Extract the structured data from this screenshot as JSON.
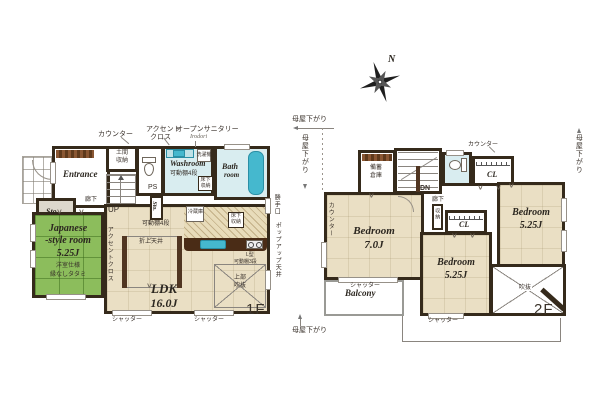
{
  "colors": {
    "wall": "#352a1b",
    "tatami": "#8cbd5c",
    "floor_beige": "#eadfc4",
    "wet_cyan": "#d9edf0",
    "fixture_cyan": "#45b8ce",
    "counter_brown": "#4a2c16"
  },
  "glyphs": {
    "door_v": "∨"
  },
  "f1": {
    "floor_label": "1F",
    "shutter": "シャッター",
    "notes": {
      "counter": "カウンター",
      "accent1": "アクセント",
      "accent2": "クロス",
      "open_sanitary": "オープンサニタリー",
      "irodori": "Irodori",
      "backdoor": "勝手口",
      "popup_ceiling": "ポップアップ天井"
    },
    "entrance": {
      "name": "Entrance",
      "doma1": "土間",
      "doma2": "収納",
      "ps": "PS",
      "up": "UP",
      "hall": "廊下",
      "sto": "Sto.",
      "sto_mid": "Sto."
    },
    "washroom": {
      "name": "Washroom",
      "shelf": "可動棚4段",
      "washer": "洗濯機",
      "uf1": "床下",
      "uf2": "収納"
    },
    "bath": {
      "name1": "Bath",
      "name2": "room"
    },
    "japanese": {
      "name1": "Japanese",
      "name2": "-style room",
      "area": "5.25J",
      "spec1": "洋室仕様",
      "spec2": "縁なしタタミ"
    },
    "ldk": {
      "name": "LDK",
      "area": "16.0J",
      "accent_wall": "アクセントクロス",
      "shelf": "可動棚4段",
      "oriage": "折上天井",
      "fridge": "冷蔵庫",
      "uf1": "床下",
      "uf2": "収納",
      "lshelf1": "L型",
      "lshelf2": "可動棚3段",
      "void1": "上部",
      "void2": "吹抜"
    }
  },
  "f2": {
    "floor_label": "2F",
    "compass_n": "N",
    "moya": "母屋下がり",
    "shutter": "シャッター",
    "notes": {
      "counter": "カウンター",
      "dn": "DN",
      "hall": "廊下",
      "cl": "CL",
      "storage": "収納",
      "stock1": "備蓄",
      "stock2": "倉庫",
      "counter_v": "カウンター"
    },
    "bed7": {
      "name": "Bedroom",
      "area": "7.0J"
    },
    "bed525r": {
      "name": "Bedroom",
      "area": "5.25J"
    },
    "bed525b": {
      "name": "Bedroom",
      "area": "5.25J"
    },
    "void": "吹抜",
    "balcony": "Balcony"
  }
}
